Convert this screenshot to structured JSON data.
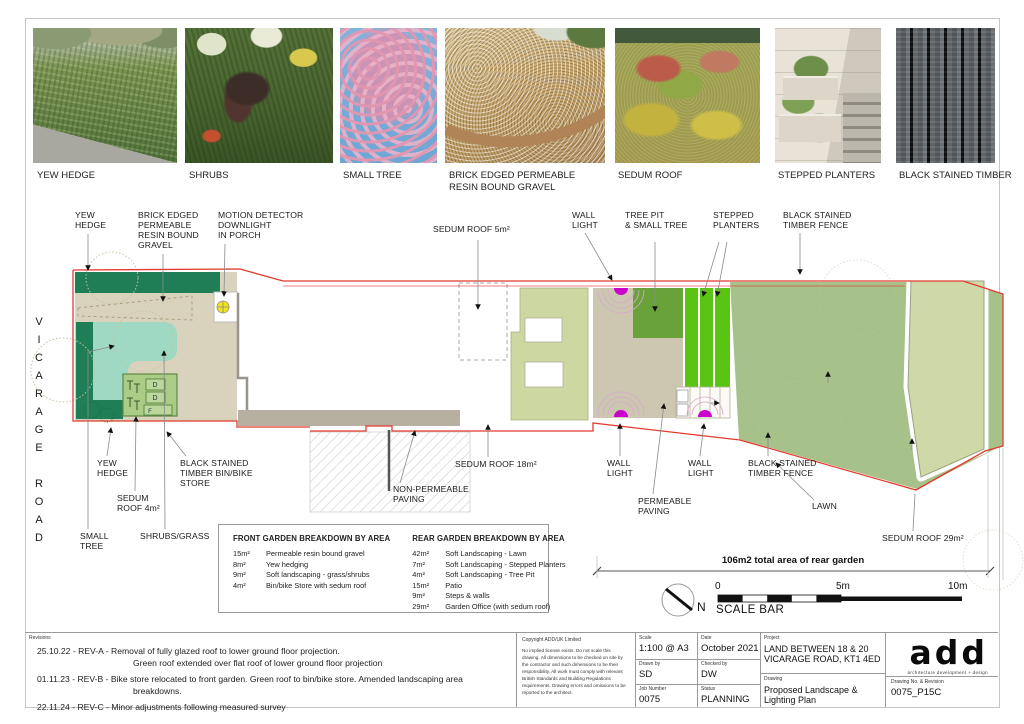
{
  "palette": {
    "boundary_red": "#e23b2e",
    "hedge_green": "#1f7e55",
    "shrub_teal": "#9fd8c3",
    "gravel_beige": "#d9d3be",
    "sedum_green": "#ccd7a2",
    "lawn_green": "#a6c189",
    "planter_green": "#59c411",
    "tree_pit_green": "#6aa23a",
    "wall_light_magenta": "#cc00cc",
    "downlight_yellow": "#f4e41c"
  },
  "photos": [
    {
      "label": "YEW HEDGE"
    },
    {
      "label": "SHRUBS"
    },
    {
      "label": "SMALL TREE"
    },
    {
      "label": "BRICK EDGED PERMEABLE\nRESIN BOUND GRAVEL"
    },
    {
      "label": "SEDUM ROOF"
    },
    {
      "label": "STEPPED PLANTERS"
    },
    {
      "label": "BLACK STAINED TIMBER"
    }
  ],
  "road_label": "VICARAGE ROAD",
  "plan": {
    "callouts": {
      "yew_top": "YEW\nHEDGE",
      "gravel": "BRICK EDGED\nPERMEABLE\nRESIN BOUND\nGRAVEL",
      "motion": "MOTION DETECTOR\nDOWNLIGHT\nIN PORCH",
      "sedum5": "SEDUM ROOF 5m²",
      "wall_top": "WALL\nLIGHT",
      "tree_pit": "TREE PIT\n& SMALL TREE",
      "stepped": "STEPPED\nPLANTERS",
      "fence_top": "BLACK STAINED\nTIMBER FENCE",
      "yew_btm": "YEW\nHEDGE",
      "bin_store": "BLACK STAINED\nTIMBER BIN/BIKE\nSTORE",
      "sedum4": "SEDUM\nROOF 4m²",
      "small_tree": "SMALL\nTREE",
      "shrubs_grass": "SHRUBS/GRASS",
      "sedum18": "SEDUM ROOF 18m²",
      "non_perm": "NON-PERMEABLE\nPAVING",
      "wall_b1": "WALL\nLIGHT",
      "perm": "PERMEABLE\nPAVING",
      "wall_b2": "WALL\nLIGHT",
      "fence_btm": "BLACK STAINED\nTIMBER FENCE",
      "lawn": "LAWN",
      "sedum29": "SEDUM ROOF 29m²"
    },
    "store": {
      "bin1": "D",
      "bin2": "D",
      "bin3": "F"
    },
    "dimension_note": "106m2 total area of rear garden",
    "north_label": "N",
    "scale_bar": {
      "zero": "0",
      "mid": "5m",
      "end": "10m",
      "caption": "SCALE BAR"
    }
  },
  "tables": {
    "front": {
      "title": "FRONT GARDEN BREAKDOWN BY AREA",
      "rows": [
        {
          "area": "15m²",
          "desc": "Permeable resin bound gravel"
        },
        {
          "area": "8m²",
          "desc": "Yew hedging"
        },
        {
          "area": "9m²",
          "desc": "Soft landscaping - grass/shrubs"
        },
        {
          "area": "4m²",
          "desc": "Bin/bike Store with sedum roof"
        }
      ]
    },
    "rear": {
      "title": "REAR GARDEN BREAKDOWN BY AREA",
      "rows": [
        {
          "area": "42m²",
          "desc": "Soft Landscaping - Lawn"
        },
        {
          "area": "7m²",
          "desc": "Soft Landscaping - Stepped Planters"
        },
        {
          "area": "4m²",
          "desc": "Soft Landscaping - Tree Pit"
        },
        {
          "area": "15m²",
          "desc": "Patio"
        },
        {
          "area": "9m²",
          "desc": "Steps & walls"
        },
        {
          "area": "29m²",
          "desc": "Garden Office (with sedum roof)"
        }
      ]
    }
  },
  "footer": {
    "revisions_label": "Revisions",
    "revisions": [
      "25.10.22  -  REV-A  -  Removal of fully glazed roof to lower ground floor projection.\nGreen roof extended over flat roof of lower ground floor projection",
      "01.11.23  -  REV-B  -  Bike store relocated to front garden. Green roof to bin/bike store. Amended landscaping area breakdowns.",
      "22.11.24 - REV-C - Minor adjustments following measured survey"
    ],
    "copyright_title": "Copyright ADD/UK Limited",
    "copyright_body": "No implied license exists.  Do not scale this drawing. All dimensions to be checked on site by the contractor and such dimensions to be their responsibility. All work must comply with relevant British Standards and Building Regulations requirements. Drawing errors and omissions to be reported to the architect.",
    "fields": {
      "scale_label": "Scale",
      "scale": "1:100 @ A3",
      "date_label": "Date",
      "date": "October 2021",
      "drawn_label": "Drawn by",
      "drawn": "SD",
      "checked_label": "Checked by",
      "checked": "DW",
      "job_label": "Job Number",
      "job": "0075",
      "status_label": "Status",
      "status": "PLANNING"
    },
    "project": {
      "label": "Project",
      "value": "LAND BETWEEN 18 & 20\nVICARAGE ROAD, KT1 4ED"
    },
    "drawing": {
      "label": "Drawing",
      "value": "Proposed Landscape &\nLighting Plan"
    },
    "drawing_no": {
      "label": "Drawing No. & Revision",
      "value": "0075_P15C"
    },
    "logo": {
      "text": "add",
      "tagline": "architecture development + design"
    }
  }
}
